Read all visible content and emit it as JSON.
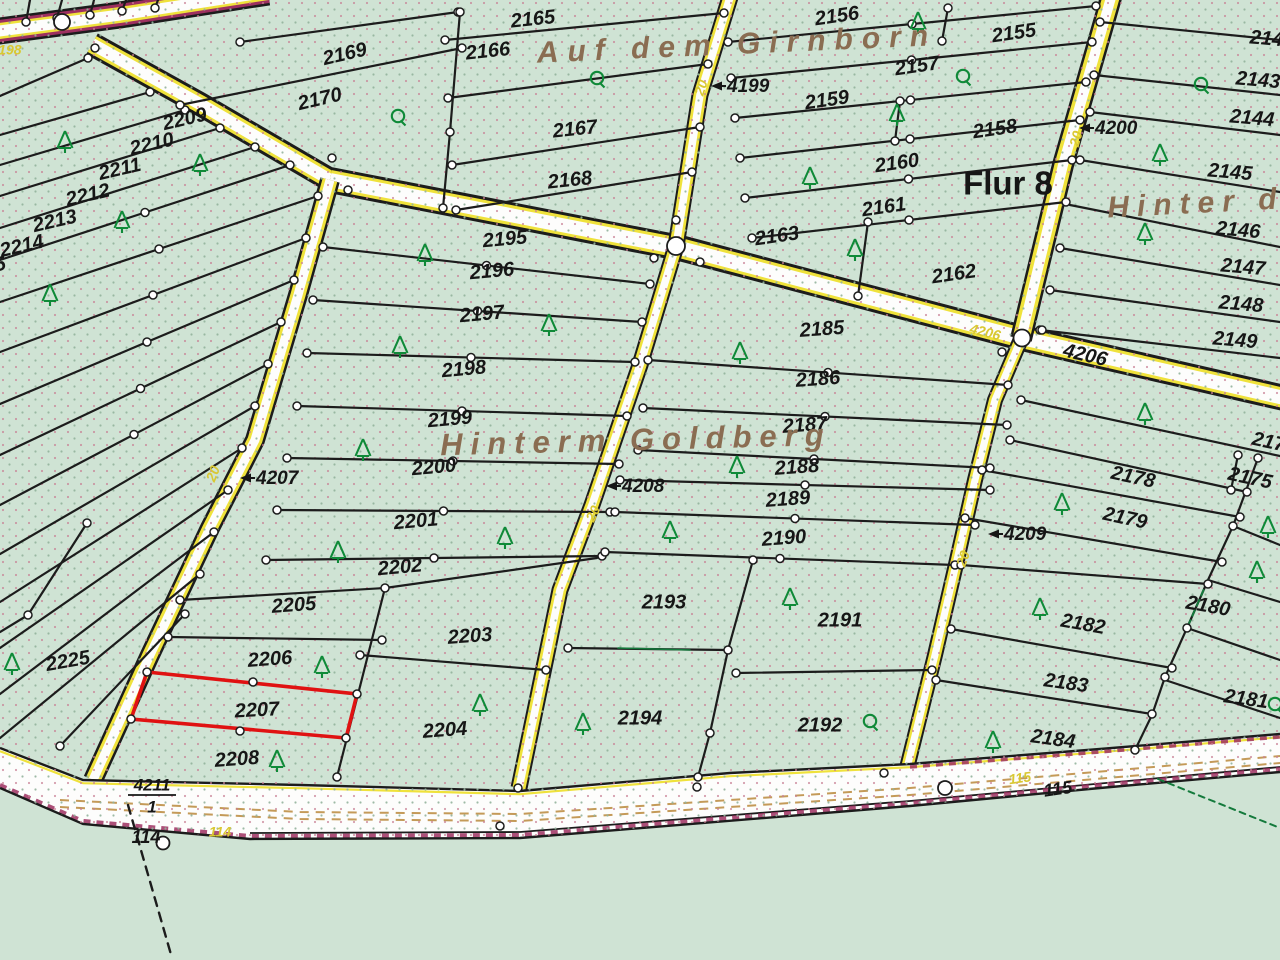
{
  "map": {
    "flur_label": {
      "text": "Flur 8",
      "x": 1008,
      "y": 186
    },
    "region_names": [
      {
        "text": "Auf dem Girnborn",
        "x": 737,
        "y": 46,
        "rot": -2.5,
        "size": 30,
        "spacing": 9
      },
      {
        "text": "Hinterm Goldberg",
        "x": 636,
        "y": 442,
        "rot": -1.5,
        "size": 31,
        "spacing": 8
      },
      {
        "text": "Hinter d",
        "x": 1196,
        "y": 205,
        "rot": -3,
        "size": 30,
        "spacing": 8
      }
    ],
    "parcels": [
      {
        "n": "2165",
        "x": 533,
        "y": 20,
        "r": -6
      },
      {
        "n": "2166",
        "x": 488,
        "y": 52,
        "r": -6
      },
      {
        "n": "2167",
        "x": 575,
        "y": 130,
        "r": -6
      },
      {
        "n": "2168",
        "x": 570,
        "y": 181,
        "r": -6
      },
      {
        "n": "2169",
        "x": 345,
        "y": 55,
        "r": -13
      },
      {
        "n": "2170",
        "x": 320,
        "y": 100,
        "r": -13
      },
      {
        "n": "2209",
        "x": 185,
        "y": 120,
        "r": -13
      },
      {
        "n": "2210",
        "x": 152,
        "y": 145,
        "r": -13
      },
      {
        "n": "2211",
        "x": 120,
        "y": 170,
        "r": -13
      },
      {
        "n": "2212",
        "x": 88,
        "y": 196,
        "r": -13
      },
      {
        "n": "2213",
        "x": 55,
        "y": 222,
        "r": -13
      },
      {
        "n": "2214",
        "x": 22,
        "y": 247,
        "r": -13
      },
      {
        "n": "2215",
        "x": -16,
        "y": 269,
        "r": -13
      },
      {
        "n": "2225",
        "x": 68,
        "y": 662,
        "r": -10
      },
      {
        "n": "2195",
        "x": 505,
        "y": 240,
        "r": -5
      },
      {
        "n": "2196",
        "x": 492,
        "y": 272,
        "r": -5
      },
      {
        "n": "2197",
        "x": 482,
        "y": 315,
        "r": -5
      },
      {
        "n": "2198",
        "x": 464,
        "y": 370,
        "r": -5
      },
      {
        "n": "2199",
        "x": 450,
        "y": 420,
        "r": -5
      },
      {
        "n": "2200",
        "x": 434,
        "y": 468,
        "r": -5
      },
      {
        "n": "2201",
        "x": 416,
        "y": 522,
        "r": -5
      },
      {
        "n": "2202",
        "x": 400,
        "y": 568,
        "r": -5
      },
      {
        "n": "2205",
        "x": 294,
        "y": 606,
        "r": -4
      },
      {
        "n": "2206",
        "x": 270,
        "y": 660,
        "r": -4
      },
      {
        "n": "2207",
        "x": 257,
        "y": 711,
        "r": -3
      },
      {
        "n": "2208",
        "x": 237,
        "y": 760,
        "r": -4
      },
      {
        "n": "2203",
        "x": 470,
        "y": 637,
        "r": -4
      },
      {
        "n": "2204",
        "x": 445,
        "y": 731,
        "r": -4
      },
      {
        "n": "2156",
        "x": 837,
        "y": 17,
        "r": -8
      },
      {
        "n": "2155",
        "x": 1014,
        "y": 34,
        "r": -8
      },
      {
        "n": "2157",
        "x": 917,
        "y": 67,
        "r": -8
      },
      {
        "n": "2159",
        "x": 827,
        "y": 101,
        "r": -8
      },
      {
        "n": "2158",
        "x": 995,
        "y": 130,
        "r": -8
      },
      {
        "n": "2160",
        "x": 897,
        "y": 164,
        "r": -8
      },
      {
        "n": "2161",
        "x": 884,
        "y": 208,
        "r": -8
      },
      {
        "n": "2162",
        "x": 954,
        "y": 275,
        "r": -8
      },
      {
        "n": "2163",
        "x": 777,
        "y": 237,
        "r": -8
      },
      {
        "n": "2185",
        "x": 822,
        "y": 330,
        "r": -4
      },
      {
        "n": "2186",
        "x": 818,
        "y": 380,
        "r": -4
      },
      {
        "n": "2187",
        "x": 805,
        "y": 426,
        "r": -4
      },
      {
        "n": "2188",
        "x": 797,
        "y": 468,
        "r": -4
      },
      {
        "n": "2189",
        "x": 788,
        "y": 500,
        "r": -4
      },
      {
        "n": "2190",
        "x": 784,
        "y": 539,
        "r": -4
      },
      {
        "n": "2193",
        "x": 664,
        "y": 603,
        "r": 0
      },
      {
        "n": "2191",
        "x": 840,
        "y": 621,
        "r": 0
      },
      {
        "n": "2194",
        "x": 640,
        "y": 719,
        "r": 0
      },
      {
        "n": "2192",
        "x": 820,
        "y": 726,
        "r": 0
      },
      {
        "n": "2142",
        "x": 1272,
        "y": 40,
        "r": 5
      },
      {
        "n": "2143",
        "x": 1258,
        "y": 81,
        "r": 5
      },
      {
        "n": "2144",
        "x": 1252,
        "y": 119,
        "r": 5
      },
      {
        "n": "2145",
        "x": 1230,
        "y": 173,
        "r": 5
      },
      {
        "n": "2146",
        "x": 1238,
        "y": 231,
        "r": 5
      },
      {
        "n": "2147",
        "x": 1243,
        "y": 268,
        "r": 5
      },
      {
        "n": "2148",
        "x": 1241,
        "y": 305,
        "r": 5
      },
      {
        "n": "2149",
        "x": 1235,
        "y": 341,
        "r": 5
      },
      {
        "n": "2176",
        "x": 1274,
        "y": 444,
        "r": 12
      },
      {
        "n": "2175",
        "x": 1250,
        "y": 479,
        "r": 12
      },
      {
        "n": "2178",
        "x": 1133,
        "y": 478,
        "r": 12
      },
      {
        "n": "2179",
        "x": 1125,
        "y": 519,
        "r": 12
      },
      {
        "n": "2180",
        "x": 1208,
        "y": 607,
        "r": 10
      },
      {
        "n": "2181",
        "x": 1246,
        "y": 700,
        "r": 8
      },
      {
        "n": "2182",
        "x": 1083,
        "y": 625,
        "r": 10
      },
      {
        "n": "2183",
        "x": 1066,
        "y": 684,
        "r": 8
      },
      {
        "n": "2184",
        "x": 1053,
        "y": 740,
        "r": 8
      }
    ],
    "arrow_road_numbers": [
      {
        "label": "4199",
        "tx": 711,
        "ty": 86
      },
      {
        "label": "4200",
        "tx": 1079,
        "ty": 128
      },
      {
        "label": "4207",
        "tx": 240,
        "ty": 478
      },
      {
        "label": "4208",
        "tx": 606,
        "ty": 486
      },
      {
        "label": "4209",
        "tx": 988,
        "ty": 534
      }
    ],
    "plain_road_numbers": [
      {
        "label": "4206",
        "x": 1085,
        "y": 356,
        "rot": 13
      }
    ],
    "fraction_road_number": {
      "numerator": "4211",
      "denominator": "1",
      "x": 152,
      "y": 786
    },
    "point_labels": [
      {
        "label": "115",
        "x": 1058,
        "y": 790,
        "rot": -8
      },
      {
        "label": "114",
        "x": 146,
        "y": 838,
        "rot": 0
      }
    ],
    "yellow_labels": [
      {
        "label": "4198",
        "x": 6,
        "y": 51,
        "rot": 0
      },
      {
        "label": "4206",
        "x": 985,
        "y": 333,
        "rot": 14
      },
      {
        "label": "115",
        "x": 1020,
        "y": 779,
        "rot": -8
      },
      {
        "label": "114",
        "x": 220,
        "y": 833,
        "rot": 0
      },
      {
        "label": "20",
        "x": 214,
        "y": 474,
        "rot": -68
      },
      {
        "label": "20",
        "x": 594,
        "y": 514,
        "rot": -64
      },
      {
        "label": "20",
        "x": 964,
        "y": 559,
        "rot": -70
      },
      {
        "label": "20",
        "x": 1077,
        "y": 139,
        "rot": -75
      },
      {
        "label": "20",
        "x": 702,
        "y": 88,
        "rot": -72
      }
    ],
    "highlighted_parcel": {
      "number": "2207",
      "outline_color": "#e01212"
    },
    "symbols": {
      "conifer_tree_positions": [
        [
          65,
          141
        ],
        [
          200,
          164
        ],
        [
          122,
          221
        ],
        [
          50,
          294
        ],
        [
          425,
          254
        ],
        [
          549,
          324
        ],
        [
          400,
          346
        ],
        [
          363,
          449
        ],
        [
          338,
          551
        ],
        [
          505,
          537
        ],
        [
          12,
          663
        ],
        [
          322,
          666
        ],
        [
          277,
          760
        ],
        [
          480,
          704
        ],
        [
          583,
          723
        ],
        [
          740,
          352
        ],
        [
          737,
          466
        ],
        [
          670,
          531
        ],
        [
          790,
          598
        ],
        [
          1040,
          608
        ],
        [
          993,
          741
        ],
        [
          918,
          22
        ],
        [
          897,
          114
        ],
        [
          810,
          177
        ],
        [
          1160,
          154
        ],
        [
          1145,
          233
        ],
        [
          855,
          249
        ],
        [
          1145,
          413
        ],
        [
          1062,
          503
        ],
        [
          1268,
          526
        ],
        [
          1257,
          571
        ]
      ],
      "deciduous_tree_positions": [
        [
          398,
          116
        ],
        [
          597,
          78
        ],
        [
          963,
          76
        ],
        [
          1201,
          84
        ],
        [
          870,
          721
        ],
        [
          1275,
          704
        ]
      ]
    },
    "colors": {
      "background": "#cfe3d4",
      "road_fill": "#fdfdfc",
      "road_edge_yellow": "#efe23b",
      "road_edge_maroon": "#9d3060",
      "boundary_black": "#1c1c1c",
      "tan_dash": "#c49a58",
      "tree_green": "#0f8a38",
      "name_brown": "#8a6d52",
      "yellow_text": "#d9c832",
      "highlight_red": "#e01212",
      "dashed_green": "#147a3c"
    }
  }
}
